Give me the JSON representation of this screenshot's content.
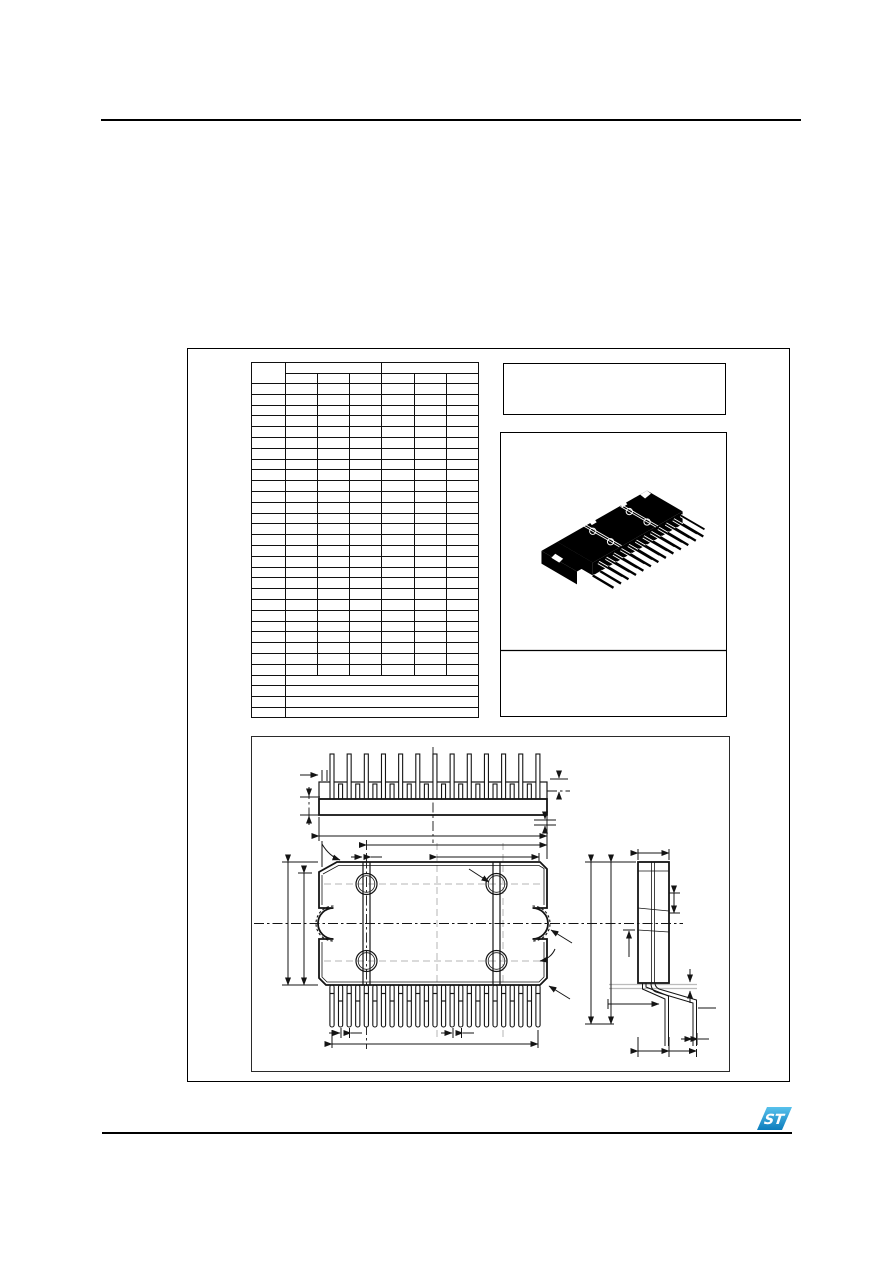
{
  "document": {
    "kind": "package-mechanical-data-page",
    "visible_text": "",
    "background": "#ffffff",
    "line_color": "#141414"
  },
  "rules": {
    "color": "#000000"
  },
  "mechanical_table": {
    "columns_total": 7,
    "dim_column_width": 33,
    "value_column_width": 32.5,
    "header_rows": 2,
    "header_groups": [
      {
        "subcolumns": 3
      },
      {
        "subcolumns": 3
      }
    ],
    "body_rows": 27,
    "note_rows": 4,
    "all_cells_empty": true
  },
  "title_box": {
    "text": ""
  },
  "package_illustration": {
    "style": "isometric",
    "body_color": "#000000",
    "seam_color": "#ffffff",
    "front_row_leads": 13,
    "back_row_leads": 12,
    "hole_rings": 4,
    "caption_text": ""
  },
  "outline_drawing": {
    "views": [
      "top-view",
      "front-view",
      "side-view"
    ],
    "top_view": {
      "tall_leads": 13,
      "short_leads": 12
    },
    "front_view": {
      "leads": 25,
      "slots": 2,
      "boss_circles": 4,
      "side_notches": 2,
      "chamfer_top_left": true
    },
    "side_view": {
      "bent_lead_rows": 2
    },
    "line_color": "#141414",
    "centerline_style": "dash-dot",
    "guide_color": "#b5b5b5"
  },
  "footer": {
    "logo": {
      "name": "st-logo",
      "letters": "ST",
      "fill_top": "#58c1ec",
      "fill_bottom": "#0c7dbd"
    }
  }
}
